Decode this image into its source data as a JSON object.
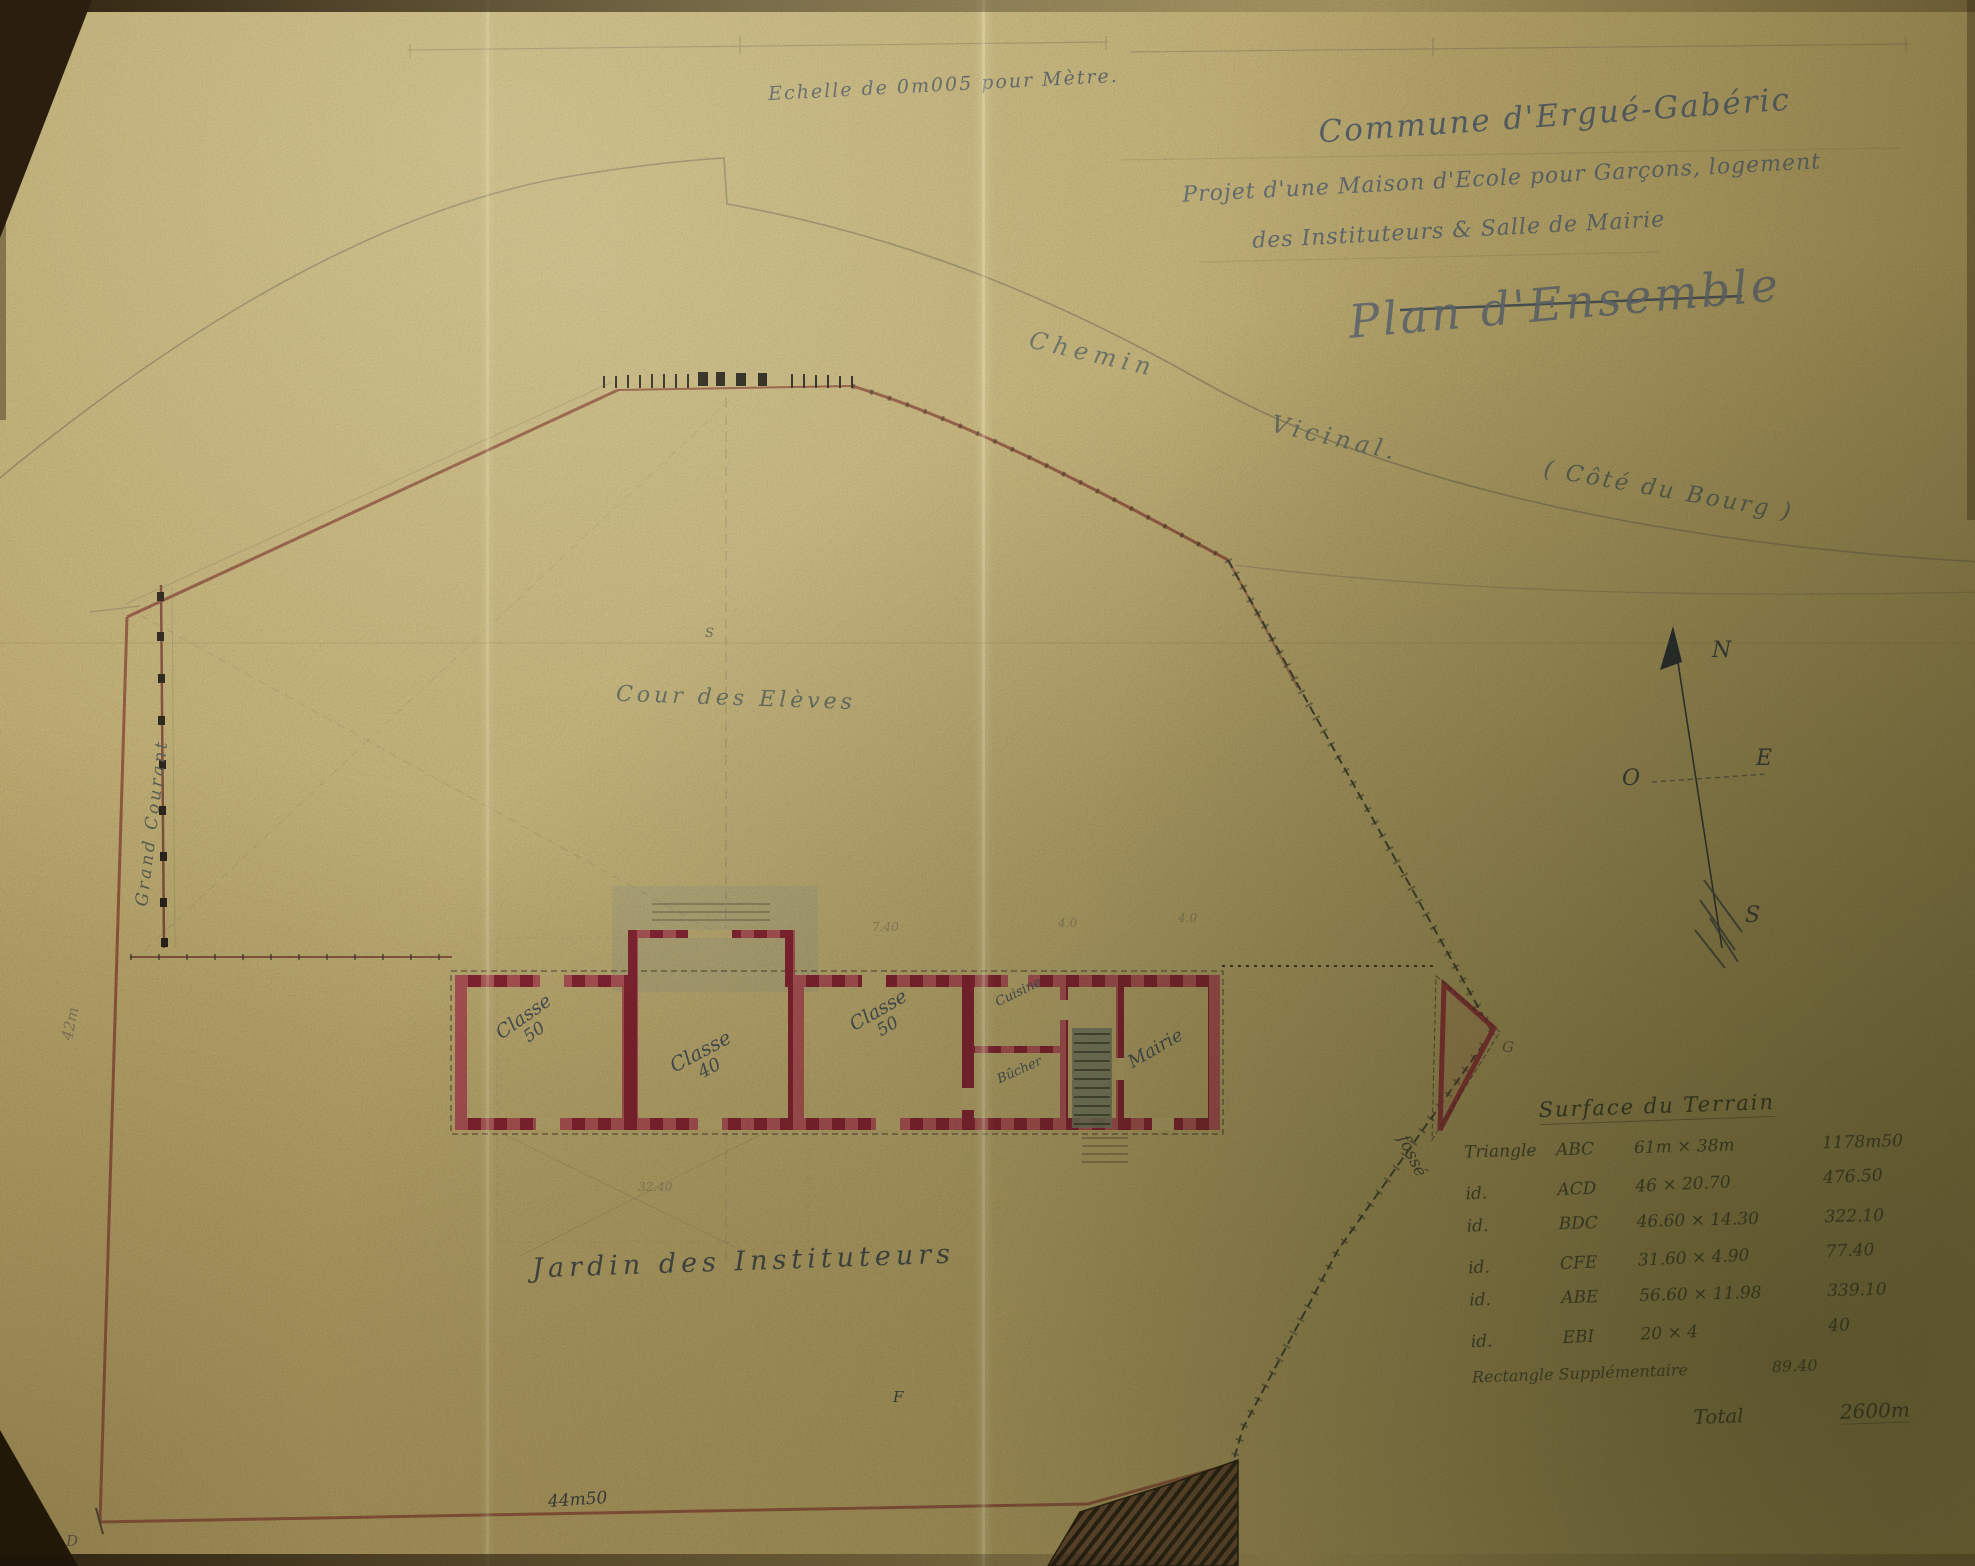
{
  "title_block": {
    "scale_note": "Echelle de 0m005 pour Mètre.",
    "commune": "Commune d'Ergué-Gabéric",
    "line2": "Projet d'une Maison d'Ecole pour Garçons, logement",
    "line3": "des Instituteurs & Salle de Mairie",
    "plan_name": "Plan d'Ensemble"
  },
  "site_labels": {
    "road_word1": "Chemin",
    "road_word2": "Vicinal.",
    "road_aside": "( Côté du Bourg )",
    "courtyard": "Cour des Elèves",
    "garden": "Jardin des Instituteurs",
    "stream": "Grand Courant",
    "ditch": "fossé"
  },
  "rooms": [
    {
      "name": "Classe",
      "number": "50"
    },
    {
      "name": "Classe",
      "number": "40"
    },
    {
      "name": "Classe",
      "number": "50"
    },
    {
      "name": "Cuisine",
      "number": ""
    },
    {
      "name": "Bûcher",
      "number": ""
    },
    {
      "name": "Mairie",
      "number": ""
    }
  ],
  "dimensions": {
    "bottom_width": "44m50",
    "left_height": "42m",
    "dim_740": "7.40",
    "dim_40a": "4.0",
    "dim_40b": "4.0",
    "dim_3240": "32.40"
  },
  "markers": {
    "d": "D",
    "f": "F",
    "g": "G",
    "s": "S"
  },
  "compass": {
    "n": "N",
    "s": "S",
    "e": "E",
    "o": "O"
  },
  "surface_table": {
    "title": "Surface du Terrain",
    "rows": [
      {
        "kind": "Triangle",
        "tri": "ABC",
        "formula": "61m × 38m",
        "value": "1178m50"
      },
      {
        "kind": "id.",
        "tri": "ACD",
        "formula": "46 × 20.70",
        "value": "476.50"
      },
      {
        "kind": "id.",
        "tri": "BDC",
        "formula": "46.60 × 14.30",
        "value": "322.10"
      },
      {
        "kind": "id.",
        "tri": "CFE",
        "formula": "31.60 × 4.90",
        "value": "77.40"
      },
      {
        "kind": "id.",
        "tri": "ABE",
        "formula": "56.60 × 11.98",
        "value": "339.10"
      },
      {
        "kind": "id.",
        "tri": "EBI",
        "formula": "20 × 4",
        "value": "40"
      }
    ],
    "extra_row": {
      "label": "Rectangle Supplémentaire",
      "value": "89.40"
    },
    "total_label": "Total",
    "total_value": "2600m"
  }
}
